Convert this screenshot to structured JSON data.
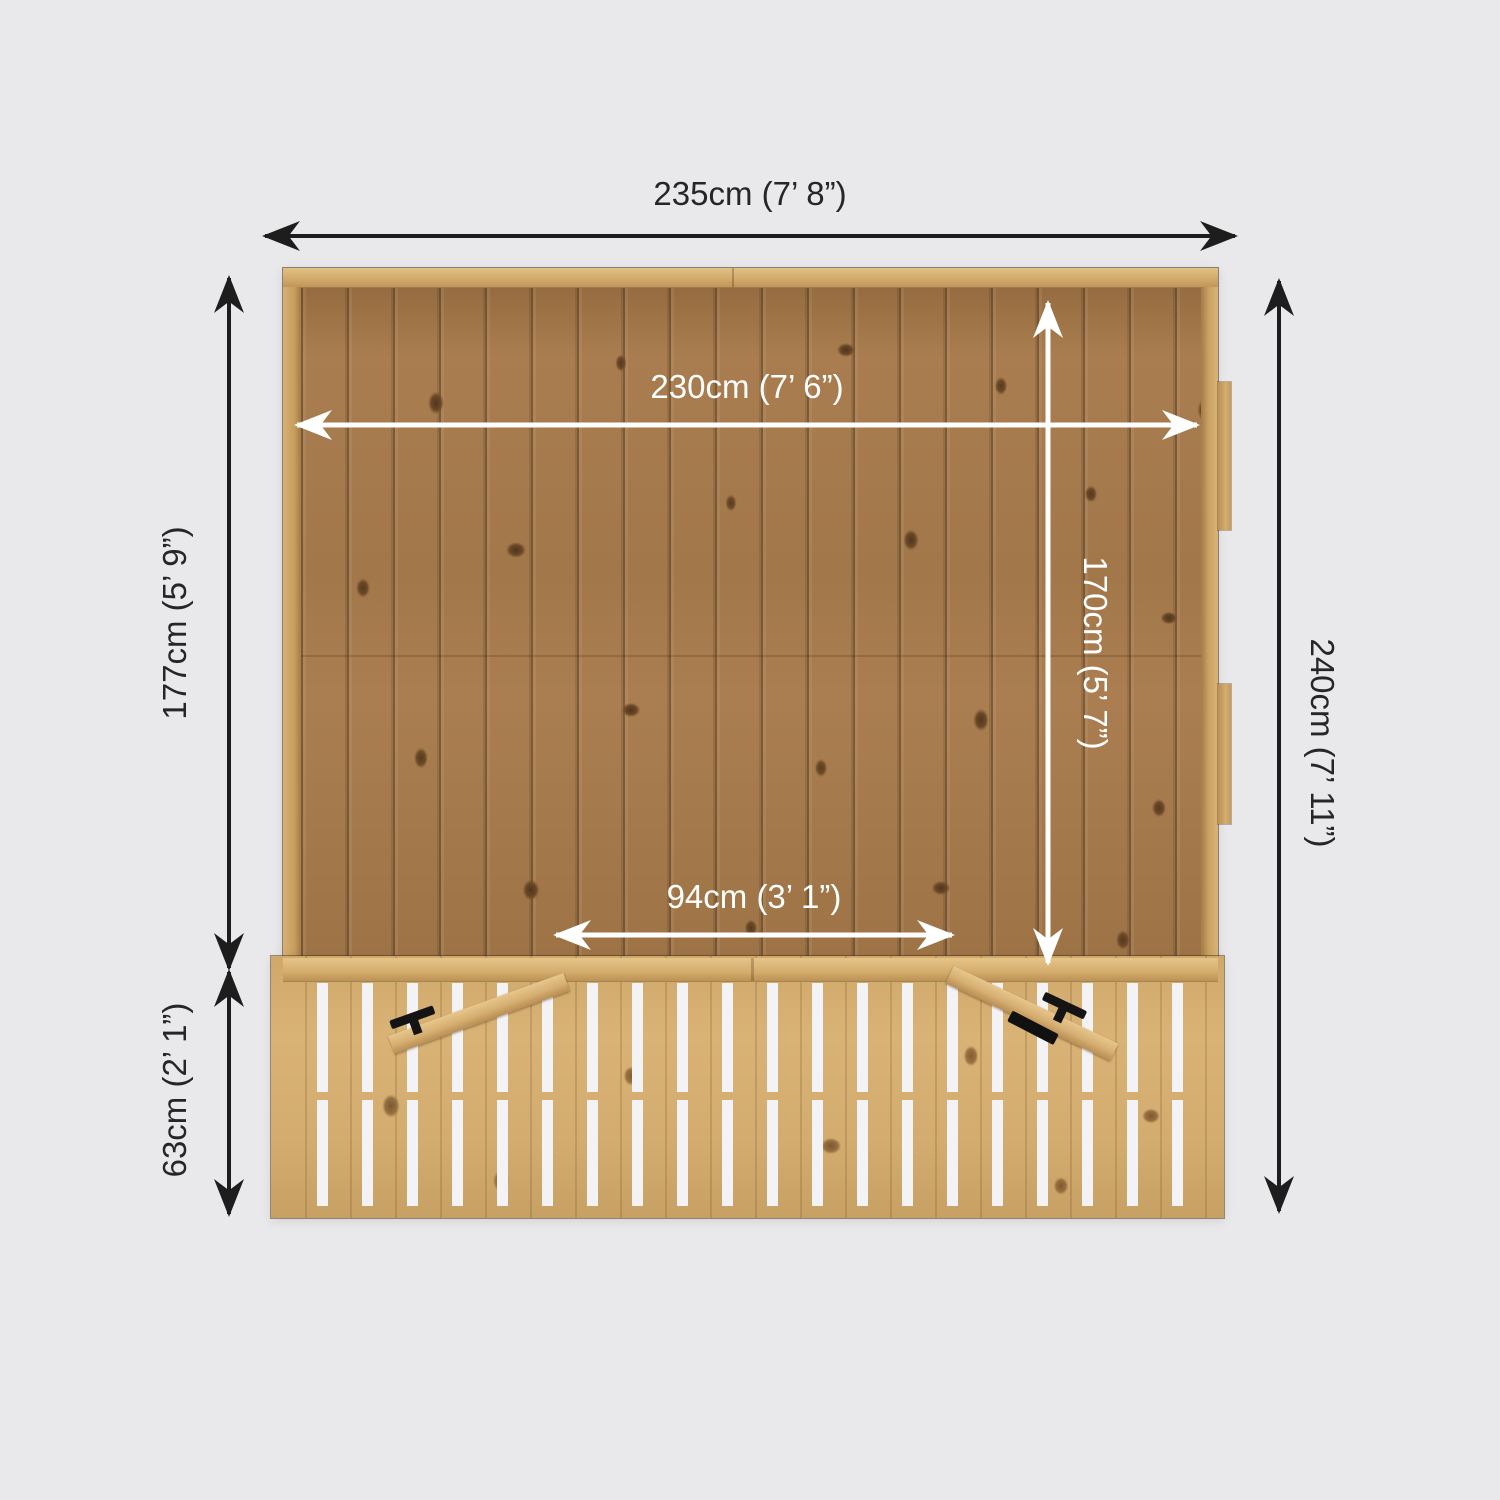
{
  "diagram": {
    "type": "product-dimension-plan",
    "subject": "wooden summerhouse with veranda, top-down plan view",
    "dimensions": {
      "overall_width": {
        "label": "235cm (7’ 8”)"
      },
      "internal_width": {
        "label": "230cm (7’ 6”)"
      },
      "building_depth": {
        "label": "177cm (5’ 9”)"
      },
      "internal_depth": {
        "label": "170cm (5’ 7”)"
      },
      "door_opening_width": {
        "label": "94cm (3’ 1”)"
      },
      "veranda_depth": {
        "label": "63cm (2’ 1”)"
      },
      "overall_depth": {
        "label": "240cm (7’ 11”)"
      }
    },
    "colors": {
      "background": "#e9e9eb",
      "dimension_dark": "#1d1d1d",
      "dimension_light": "#ffffff",
      "wood_roof": "#a2774a",
      "wood_frame": "#d2ab6c",
      "wood_deck": "#d3ac6f",
      "deck_slot": "#f3f2f4",
      "hardware": "#141414"
    }
  }
}
